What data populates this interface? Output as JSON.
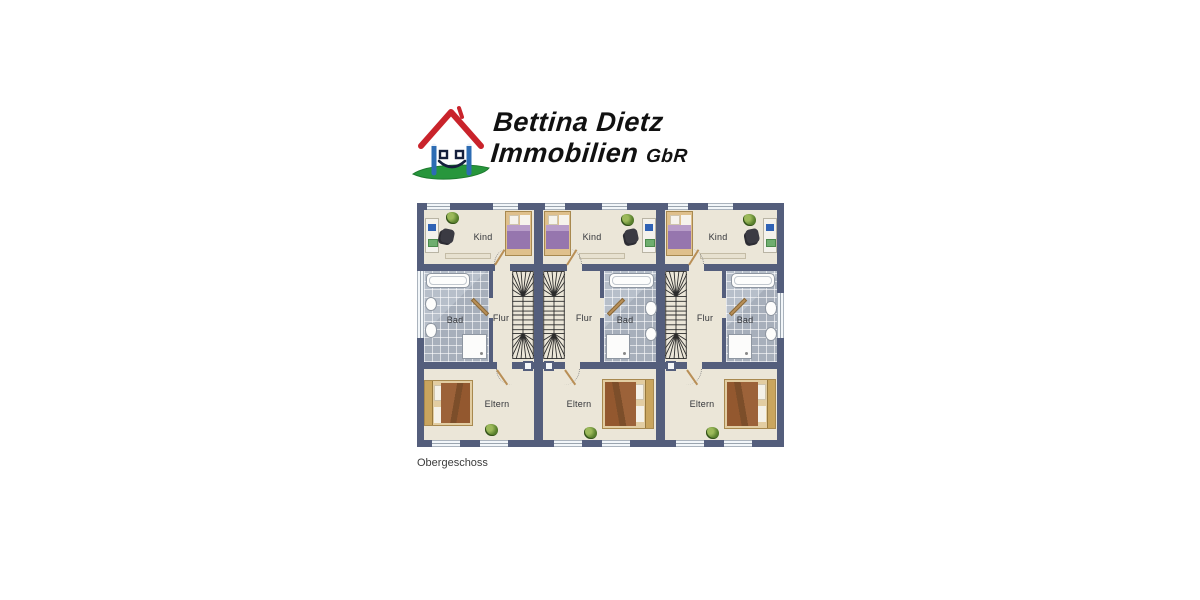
{
  "logo": {
    "line1": "Bettina Dietz",
    "line2": "Immobilien",
    "gbr": "GbR",
    "icon": "smiling-house-logo",
    "colors": {
      "roof": "#c9232b",
      "wall_stroke": "#2d6cb3",
      "grass": "#27963c",
      "text": "#111111"
    }
  },
  "plan": {
    "caption": "Obergeschoss",
    "colors": {
      "wall": "#545e7c",
      "floor": "#ebe6d8",
      "tile": "#b0b8c3",
      "window": "#f2f6f9"
    },
    "units": [
      {
        "name": "unit-1",
        "layout": "bath-on-left",
        "rooms": {
          "kind": "Kind",
          "bad": "Bad",
          "flur": "Flur",
          "eltern": "Eltern"
        }
      },
      {
        "name": "unit-2",
        "layout": "bath-on-right",
        "rooms": {
          "kind": "Kind",
          "bad": "Bad",
          "flur": "Flur",
          "eltern": "Eltern"
        }
      },
      {
        "name": "unit-3",
        "layout": "bath-on-right",
        "rooms": {
          "kind": "Kind",
          "bad": "Bad",
          "flur": "Flur",
          "eltern": "Eltern"
        }
      }
    ]
  }
}
